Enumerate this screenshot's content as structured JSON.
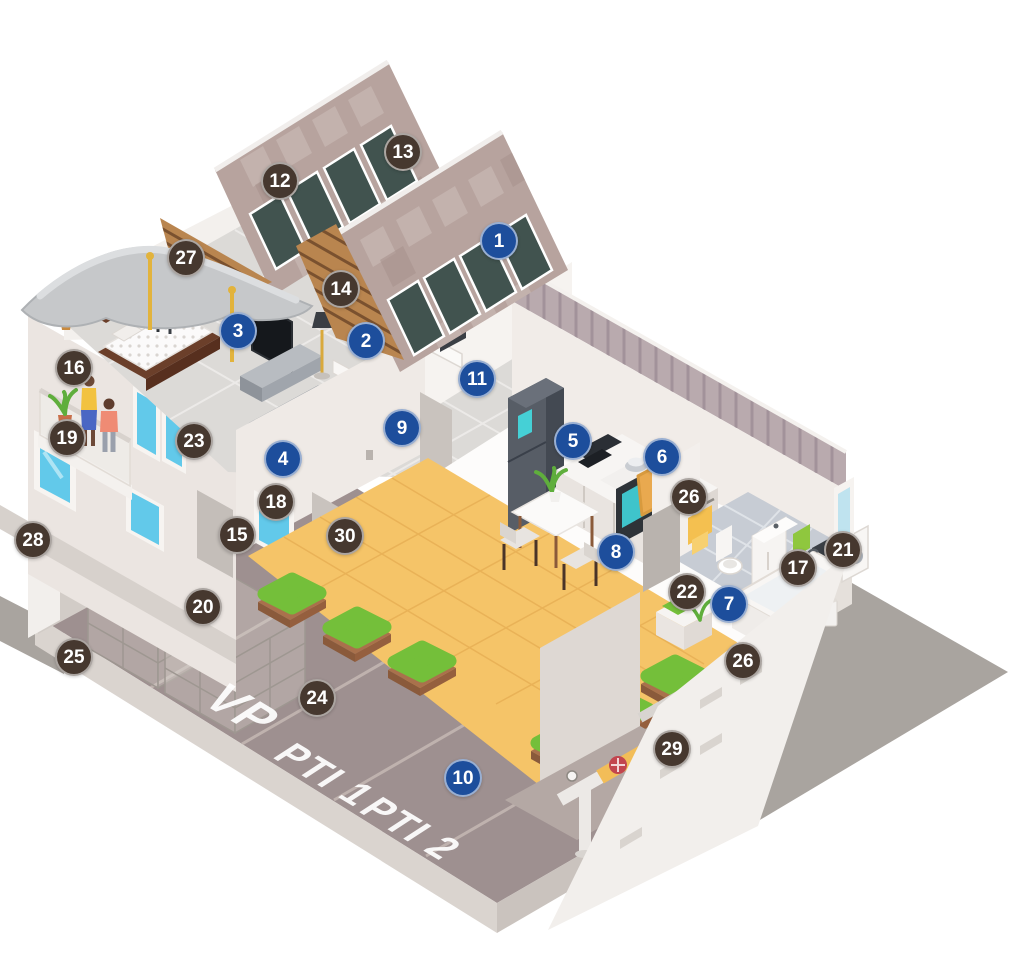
{
  "scene": {
    "description": "Isometric cutaway illustration of a two-storey residential building with solar roof, bedroom, living room, kitchen, bathroom, terrace, parking garage level and basement piping, annotated with numbered points of interest",
    "background": "#ffffff"
  },
  "palette": {
    "marker_blue": "#1d4e9c",
    "marker_brown": "#46382f",
    "marker_text": "#ffffff",
    "roof": "#b7a39e",
    "roof_check_light": "#c6b5b0",
    "roof_check_dark": "#a8938e",
    "solar_panel": "#41534f",
    "wood_slats": "#b9854f",
    "insulation_gray": "#c6c8ca",
    "terrace_floor": "#f5c468",
    "parking_floor": "#9e9090",
    "hedge_green": "#74bf3a",
    "facade": "#ebe5e1",
    "window_glass": "#62c9ea",
    "fence": "#b9aaae",
    "ground_shadow": "#a9a49f",
    "fire_cabinet_red": "#d6333b",
    "pipe_yellow": "#f2bd58",
    "valve_red": "#c2454e"
  },
  "parking_labels": [
    "VP",
    "PTI 1",
    "PTI 2"
  ],
  "markers": [
    {
      "n": "1",
      "variant": "blue",
      "x": 499,
      "y": 241
    },
    {
      "n": "2",
      "variant": "blue",
      "x": 366,
      "y": 341
    },
    {
      "n": "3",
      "variant": "blue",
      "x": 238,
      "y": 331
    },
    {
      "n": "4",
      "variant": "blue",
      "x": 283,
      "y": 459
    },
    {
      "n": "5",
      "variant": "blue",
      "x": 573,
      "y": 441
    },
    {
      "n": "6",
      "variant": "blue",
      "x": 662,
      "y": 457
    },
    {
      "n": "7",
      "variant": "blue",
      "x": 729,
      "y": 604
    },
    {
      "n": "8",
      "variant": "blue",
      "x": 616,
      "y": 552
    },
    {
      "n": "9",
      "variant": "blue",
      "x": 402,
      "y": 428
    },
    {
      "n": "10",
      "variant": "blue",
      "x": 463,
      "y": 778
    },
    {
      "n": "11",
      "variant": "blue",
      "x": 477,
      "y": 379
    },
    {
      "n": "12",
      "variant": "brown",
      "x": 280,
      "y": 181
    },
    {
      "n": "13",
      "variant": "brown",
      "x": 403,
      "y": 152
    },
    {
      "n": "14",
      "variant": "brown",
      "x": 341,
      "y": 289
    },
    {
      "n": "15",
      "variant": "brown",
      "x": 237,
      "y": 535
    },
    {
      "n": "16",
      "variant": "brown",
      "x": 74,
      "y": 368
    },
    {
      "n": "17",
      "variant": "brown",
      "x": 798,
      "y": 568
    },
    {
      "n": "18",
      "variant": "brown",
      "x": 276,
      "y": 502
    },
    {
      "n": "19",
      "variant": "brown",
      "x": 67,
      "y": 438
    },
    {
      "n": "20",
      "variant": "brown",
      "x": 203,
      "y": 607
    },
    {
      "n": "21",
      "variant": "brown",
      "x": 843,
      "y": 550
    },
    {
      "n": "22",
      "variant": "brown",
      "x": 687,
      "y": 592
    },
    {
      "n": "23",
      "variant": "brown",
      "x": 194,
      "y": 441
    },
    {
      "n": "24",
      "variant": "brown",
      "x": 317,
      "y": 698
    },
    {
      "n": "25",
      "variant": "brown",
      "x": 74,
      "y": 657
    },
    {
      "n": "26",
      "key": "26a",
      "variant": "brown",
      "x": 689,
      "y": 497
    },
    {
      "n": "26",
      "key": "26b",
      "variant": "brown",
      "x": 743,
      "y": 661
    },
    {
      "n": "27",
      "variant": "brown",
      "x": 186,
      "y": 258
    },
    {
      "n": "28",
      "variant": "brown",
      "x": 33,
      "y": 540
    },
    {
      "n": "29",
      "variant": "brown",
      "x": 672,
      "y": 749
    },
    {
      "n": "30",
      "variant": "brown",
      "x": 345,
      "y": 536
    }
  ]
}
